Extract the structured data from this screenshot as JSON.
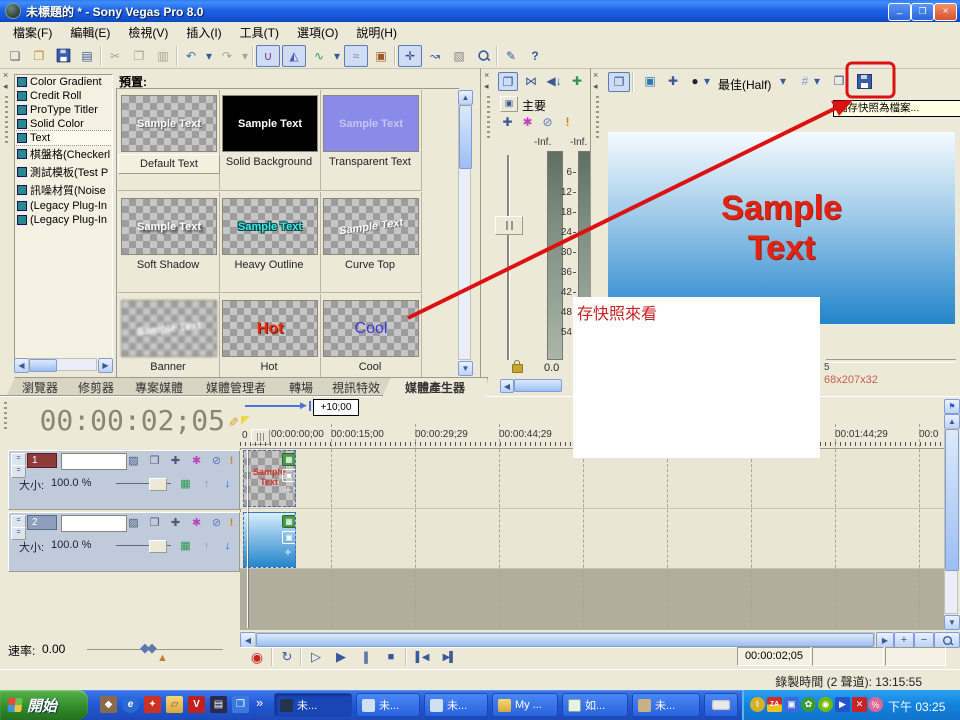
{
  "window": {
    "title": "未標題的 * - Sony Vegas Pro 8.0"
  },
  "menu": [
    "檔案(F)",
    "編輯(E)",
    "檢視(V)",
    "插入(I)",
    "工具(T)",
    "選項(O)",
    "說明(H)"
  ],
  "generators": [
    "Color Gradient",
    "Credit Roll",
    "ProType Titler",
    "Solid Color",
    "Text",
    "棋盤格(Checkerl",
    "測試模板(Test P",
    "訊噪材質(Noise",
    "(Legacy Plug-In",
    "(Legacy Plug-In"
  ],
  "presets": {
    "label": "預置:",
    "items": [
      {
        "name": "Default Text",
        "text": "Sample Text"
      },
      {
        "name": "Solid Background",
        "text": "Sample Text"
      },
      {
        "name": "Transparent Text",
        "text": "Sample Text"
      },
      {
        "name": "Soft Shadow",
        "text": "Sample Text"
      },
      {
        "name": "Heavy Outline",
        "text": "Sample Text"
      },
      {
        "name": "Curve Top",
        "text": "Sample Text"
      },
      {
        "name": "Banner",
        "text": "Sample Text"
      },
      {
        "name": "Hot",
        "text": "Hot"
      },
      {
        "name": "Cool",
        "text": "Cool"
      }
    ]
  },
  "tabs": [
    "瀏覽器",
    "修剪器",
    "專案媒體",
    "媒體管理者",
    "轉場",
    "視訊特效",
    "媒體產生器"
  ],
  "mixer": {
    "master": "主要",
    "inf1": "-Inf.",
    "inf2": "-Inf.",
    "scale": [
      "6",
      "12",
      "18",
      "24",
      "30",
      "36",
      "42",
      "48",
      "54"
    ],
    "gain": "0.0"
  },
  "preview": {
    "quality": "最佳(Half)",
    "tooltip": "儲存快照為檔案...",
    "line1": "Sample",
    "line2": "Text",
    "status1": "5",
    "status2": "68x207x32"
  },
  "note": {
    "text": "存快照來看"
  },
  "timeline": {
    "time": "00:00:02;05",
    "offset": "+10;00",
    "ruler_zero": "0",
    "ruler": [
      "00:00:00;00",
      "00:00:15;00",
      "00:00:29;29",
      "00:00:44;29",
      "00:01:44;29",
      "00:0"
    ],
    "tracks": [
      {
        "num": "1",
        "size_label": "大小:",
        "size": "100.0 %",
        "clip_text": "Sample Text"
      },
      {
        "num": "2",
        "size_label": "大小:",
        "size": "100.0 %"
      }
    ],
    "rate_label": "速率:",
    "rate": "0.00",
    "transport_time": "00:00:02;05"
  },
  "status": {
    "record": "錄製時間 (2 聲道): 13:15:55"
  },
  "taskbar": {
    "start": "開始",
    "overflow": "»",
    "tray_badge": "ZA",
    "tasks": [
      {
        "label": "未..."
      },
      {
        "label": "未..."
      },
      {
        "label": "未..."
      },
      {
        "label": "My ..."
      },
      {
        "label": "如..."
      },
      {
        "label": "未..."
      }
    ],
    "clock": "下午 03:25"
  }
}
